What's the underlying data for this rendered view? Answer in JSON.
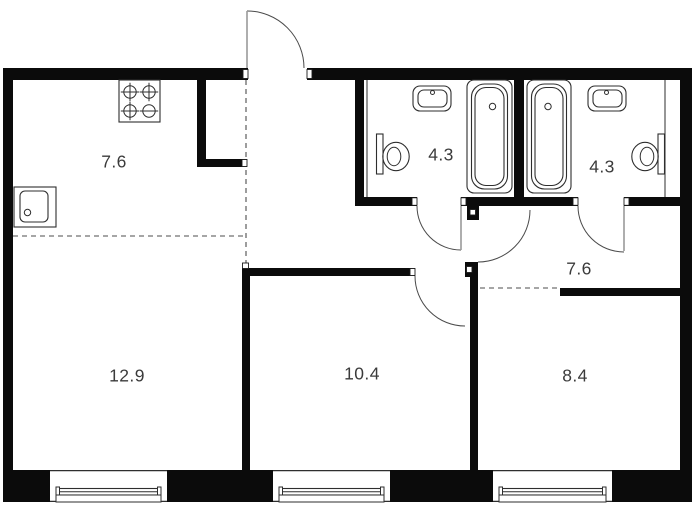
{
  "canvas": {
    "width": 700,
    "height": 517,
    "background": "#ffffff",
    "wall_color": "#0b0b0b",
    "line_color": "#2e2e2e",
    "arc_color": "#4a4a4a",
    "leaf_color": "#9a9a9a",
    "label_color": "#3b3b3b"
  },
  "rooms": [
    {
      "name": "kitchen",
      "label": "7.6",
      "cx": 114,
      "cy": 162
    },
    {
      "name": "bathroom-left",
      "label": "4.3",
      "cx": 441,
      "cy": 155
    },
    {
      "name": "bathroom-right",
      "label": "4.3",
      "cx": 602,
      "cy": 167
    },
    {
      "name": "hallway",
      "label": "7.6",
      "cx": 579,
      "cy": 269
    },
    {
      "name": "living-room",
      "label": "12.9",
      "cx": 127,
      "cy": 376
    },
    {
      "name": "room-middle",
      "label": "10.4",
      "cx": 362,
      "cy": 374
    },
    {
      "name": "room-right",
      "label": "8.4",
      "cx": 575,
      "cy": 376
    }
  ],
  "walls": [
    {
      "name": "outer-wall-top-left",
      "x": 3,
      "y": 68,
      "w": 245,
      "h": 12
    },
    {
      "name": "outer-wall-top-right",
      "x": 307,
      "y": 68,
      "w": 385,
      "h": 12
    },
    {
      "name": "outer-wall-left",
      "x": 3,
      "y": 68,
      "w": 10,
      "h": 434
    },
    {
      "name": "outer-wall-right",
      "x": 680,
      "y": 68,
      "w": 12,
      "h": 434
    },
    {
      "name": "bottom-pier-1",
      "x": 3,
      "y": 470,
      "w": 47,
      "h": 32
    },
    {
      "name": "bottom-pier-2",
      "x": 167,
      "y": 470,
      "w": 106,
      "h": 32
    },
    {
      "name": "bottom-pier-3",
      "x": 390,
      "y": 470,
      "w": 103,
      "h": 32
    },
    {
      "name": "bottom-pier-4",
      "x": 612,
      "y": 470,
      "w": 80,
      "h": 32
    },
    {
      "name": "kitchen-wall-vertical",
      "x": 197,
      "y": 80,
      "w": 9,
      "h": 87
    },
    {
      "name": "kitchen-wall-horizontal",
      "x": 197,
      "y": 159,
      "w": 50,
      "h": 8
    },
    {
      "name": "bath-left-wall",
      "x": 355,
      "y": 80,
      "w": 9,
      "h": 126
    },
    {
      "name": "tub-divider-wall",
      "x": 514,
      "y": 80,
      "w": 10,
      "h": 126
    },
    {
      "name": "bath-bottom-wall-a",
      "x": 355,
      "y": 197,
      "w": 62,
      "h": 9
    },
    {
      "name": "bath-bottom-wall-b",
      "x": 461,
      "y": 197,
      "w": 117,
      "h": 9
    },
    {
      "name": "bath-bottom-wall-c",
      "x": 624,
      "y": 197,
      "w": 56,
      "h": 9
    },
    {
      "name": "corridor-door-hinge-block",
      "x": 467,
      "y": 206,
      "w": 12,
      "h": 14
    },
    {
      "name": "living-room-divider-wall",
      "x": 242,
      "y": 268,
      "w": 8,
      "h": 202
    },
    {
      "name": "room-middle-top-wall",
      "x": 242,
      "y": 268,
      "w": 173,
      "h": 8
    },
    {
      "name": "room-divider-hinge-block",
      "x": 465,
      "y": 262,
      "w": 13,
      "h": 15
    },
    {
      "name": "room-divider-wall",
      "x": 470,
      "y": 262,
      "w": 8,
      "h": 208
    },
    {
      "name": "room-right-top-wall",
      "x": 560,
      "y": 288,
      "w": 120,
      "h": 8
    }
  ],
  "jambs": [
    {
      "name": "jamb-entrance-left",
      "x": 243,
      "y": 69.5,
      "w": 5,
      "h": 9
    },
    {
      "name": "jamb-entrance-right",
      "x": 307,
      "y": 69.5,
      "w": 5,
      "h": 9
    },
    {
      "name": "jamb-bath1-left",
      "x": 412,
      "y": 197.8,
      "w": 5,
      "h": 7.5
    },
    {
      "name": "jamb-bath1-right",
      "x": 461,
      "y": 197.8,
      "w": 5,
      "h": 7.5
    },
    {
      "name": "jamb-bath2-left",
      "x": 573,
      "y": 197.8,
      "w": 5,
      "h": 7.5
    },
    {
      "name": "jamb-bath2-right",
      "x": 624,
      "y": 197.8,
      "w": 5,
      "h": 7.5
    },
    {
      "name": "jamb-room-middle",
      "x": 410,
      "y": 268.5,
      "w": 5,
      "h": 7
    },
    {
      "name": "jamb-kitchen-wall",
      "x": 242,
      "y": 159.5,
      "w": 5,
      "h": 7
    },
    {
      "name": "jamb-divider-top",
      "x": 242.5,
      "y": 263,
      "w": 6,
      "h": 5.5
    },
    {
      "name": "hinge-inset-corridor",
      "x": 470,
      "y": 209.5,
      "w": 5.5,
      "h": 5.5
    },
    {
      "name": "hinge-inset-room",
      "x": 466.5,
      "y": 266.5,
      "w": 5.5,
      "h": 6
    }
  ],
  "thin_lines": [
    {
      "name": "bath1-shaft-line",
      "x1": 367,
      "y1": 80,
      "x2": 367,
      "y2": 197
    },
    {
      "name": "bath2-shaft-line",
      "x1": 665,
      "y1": 80,
      "x2": 665,
      "y2": 197
    }
  ],
  "dashed_lines": [
    {
      "name": "zone-dash-vertical",
      "x1": 246,
      "y1": 80,
      "x2": 246,
      "y2": 267
    },
    {
      "name": "zone-dash-kitchen",
      "x1": 13,
      "y1": 236,
      "x2": 246,
      "y2": 236
    },
    {
      "name": "zone-dash-room-right",
      "x1": 480,
      "y1": 288,
      "x2": 560,
      "y2": 288
    }
  ],
  "doors": [
    {
      "name": "door-entrance",
      "arc": "M247,11 A57,57 0 0 1 304,68",
      "leaf": {
        "x1": 247,
        "y1": 68,
        "x2": 247,
        "y2": 11
      }
    },
    {
      "name": "door-bath-left",
      "arc": "M417,206 A44,44 0 0 0 461,250",
      "leaf": {
        "x1": 461,
        "y1": 206,
        "x2": 461,
        "y2": 250
      }
    },
    {
      "name": "door-corridor",
      "arc": "M530,210 A52,52 0 0 1 478,262",
      "leaf": null
    },
    {
      "name": "door-bath-right",
      "arc": "M578,206 A46,46 0 0 0 624,252",
      "leaf": {
        "x1": 624,
        "y1": 206,
        "x2": 624,
        "y2": 251
      }
    },
    {
      "name": "door-room-middle",
      "arc": "M415,276 A50,50 0 0 0 465,326",
      "leaf": null
    }
  ],
  "windows": {
    "y": 470,
    "h": 32,
    "items": [
      {
        "name": "window-living-left",
        "x": 50,
        "w": 117
      },
      {
        "name": "window-living-right",
        "x": 273,
        "w": 117
      },
      {
        "name": "window-room-right",
        "x": 493,
        "w": 119
      }
    ]
  },
  "fixtures": {
    "stove": {
      "name": "stove-icon",
      "x": 119,
      "y": 80,
      "w": 41,
      "h": 42,
      "burners": [
        {
          "cx": 130,
          "cy": 92,
          "r": 6.2,
          "cross": "both"
        },
        {
          "cx": 149,
          "cy": 92,
          "r": 6.2,
          "cross": "both"
        },
        {
          "cx": 130,
          "cy": 111,
          "r": 6.2,
          "cross": "both"
        },
        {
          "cx": 149,
          "cy": 111,
          "r": 6.2,
          "cross": "horizontal"
        }
      ]
    },
    "kitchen_sink": {
      "name": "kitchen-sink-icon",
      "outer": [
        14,
        187,
        42,
        40
      ],
      "inner": [
        20,
        191,
        28,
        31
      ],
      "dot": [
        27.5,
        212.5,
        3.2
      ]
    },
    "bathtubs": [
      {
        "name": "bathtub-left-icon",
        "outer": [
          467,
          80,
          45,
          113
        ],
        "inner1": [
          471.5,
          84,
          36,
          105
        ],
        "inner2": [
          475,
          87.5,
          29,
          98
        ],
        "drain": [
          492.5,
          106.5,
          3.2
        ]
      },
      {
        "name": "bathtub-right-icon",
        "outer": [
          527,
          80,
          44,
          113
        ],
        "inner1": [
          531.5,
          84,
          35,
          105
        ],
        "inner2": [
          535,
          87.5,
          28,
          98
        ],
        "drain": [
          548,
          106.5,
          3.2
        ]
      }
    ],
    "bath_sinks": [
      {
        "name": "washbasin-left-icon",
        "outer": [
          413,
          86,
          38,
          25
        ],
        "inner": [
          418,
          90,
          29,
          17
        ],
        "dot": [
          432.5,
          92.5,
          2
        ]
      },
      {
        "name": "washbasin-right-icon",
        "outer": [
          588,
          86,
          38,
          25
        ],
        "inner": [
          593,
          90,
          29,
          17
        ],
        "dot": [
          606.5,
          92.5,
          2
        ]
      }
    ],
    "toilets": [
      {
        "name": "toilet-left-icon",
        "cistern": [
          376.5,
          134,
          6.5,
          40
        ],
        "bowl": [
          396,
          156.5,
          13.2,
          14.2
        ],
        "bowl_inner": [
          394,
          156.5,
          6.8,
          9.2
        ]
      },
      {
        "name": "toilet-right-icon",
        "cistern": [
          658,
          134,
          6.5,
          40
        ],
        "bowl": [
          645,
          156.5,
          13.2,
          14.2
        ],
        "bowl_inner": [
          647,
          156.5,
          6.8,
          9.2
        ]
      }
    ]
  }
}
